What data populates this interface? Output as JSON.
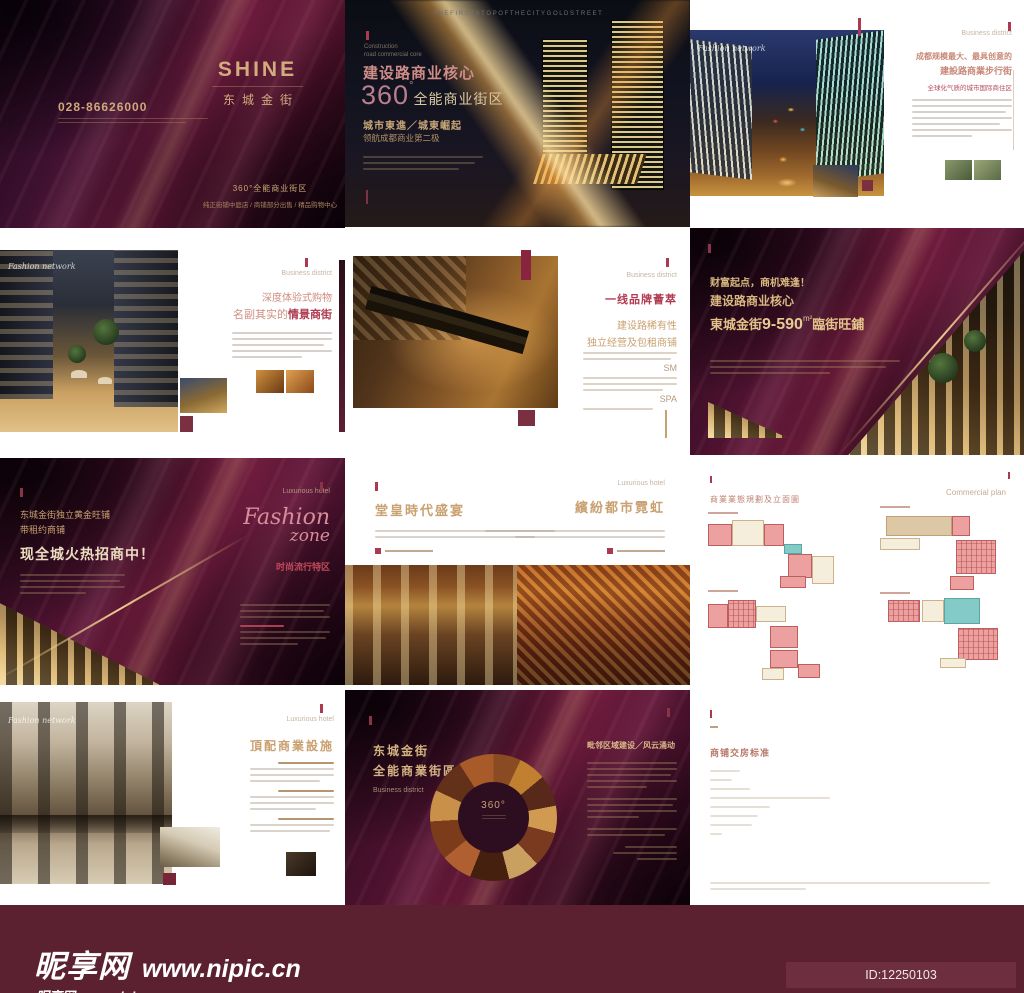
{
  "colors": {
    "maroon_bar": "#5b2130",
    "deep_maroon": "#4e1230",
    "gold": "#c9a578",
    "red_accent": "#a93a50",
    "plan_red": "#eda0a0",
    "plan_tan": "#ddc8a6",
    "plan_teal": "#84cbc8"
  },
  "site": {
    "name": "昵享网",
    "url": "www.nipic.cn",
    "id_text": "ID:12250103 NO:20161227175712297032"
  },
  "cover": {
    "logo": "SHINE",
    "logo_cn": "东城金街",
    "phone": "028-86626000",
    "slogan": "360°全能商业街区",
    "slogan_sub": "纯正街铺中庭店 / 商铺部分出售 / 精品购物中心"
  },
  "core": {
    "top_en": "T H E   F I R S T   S T O P   O F   T H E   C I T Y   G O L D   S T R E E T",
    "eyebrow1": "Construction",
    "eyebrow2": "road commercial core",
    "h1": "建设路商业核心",
    "big_num": "360",
    "deg": "°",
    "h2": "全能商业街区",
    "sub1": "城市東進／城東崛起",
    "sub2": "领航成都商业第二极"
  },
  "street": {
    "label": "Business district",
    "watermark": "Fashion network",
    "h1": "成都规模最大、最具创意的",
    "h2": "建設路商業步行街",
    "sub_red": "全球化气质的城市国际商住区"
  },
  "shopping": {
    "label": "Business district",
    "watermark": "Fashion network",
    "h1": "深度体验式购物",
    "h2_plain": "名副其实的",
    "h2_red": "情景商街"
  },
  "brands": {
    "label": "Business district",
    "h_red": "一线品牌薈萃",
    "h1": "建设路稀有性",
    "h2": "独立经营及包租商铺",
    "tok1": "SM",
    "tok2": "SPA"
  },
  "wealth": {
    "l1": "财富起点，商机难逢！",
    "l2": "建设路商业核心",
    "brand": "東城金街",
    "num": "9-590",
    "unit": "m²",
    "tail": "臨街旺鋪"
  },
  "fashion": {
    "label": "Luxurious hotel",
    "l1": "东城金街独立黄金旺铺",
    "l2": "带租约商铺",
    "big": "现全城火热招商中！",
    "script1": "Fashion",
    "script2": "zone",
    "sub_red": "时尚流行特区"
  },
  "feast": {
    "label": "Luxurious hotel",
    "h_left": "堂皇時代盛宴",
    "h_right": "繽紛都市霓虹"
  },
  "plans": {
    "title": "商業業態規劃及立面圖",
    "label": "Commercial plan"
  },
  "facility": {
    "label": "Luxurious hotel",
    "h": "頂配商業設施"
  },
  "ring": {
    "h1": "东城金街",
    "h2": "全能商業街區",
    "label": "Business district",
    "center": "360°",
    "h_right": "毗邻区域建设／风云涌动"
  },
  "standards": {
    "title": "商铺交房标准"
  }
}
